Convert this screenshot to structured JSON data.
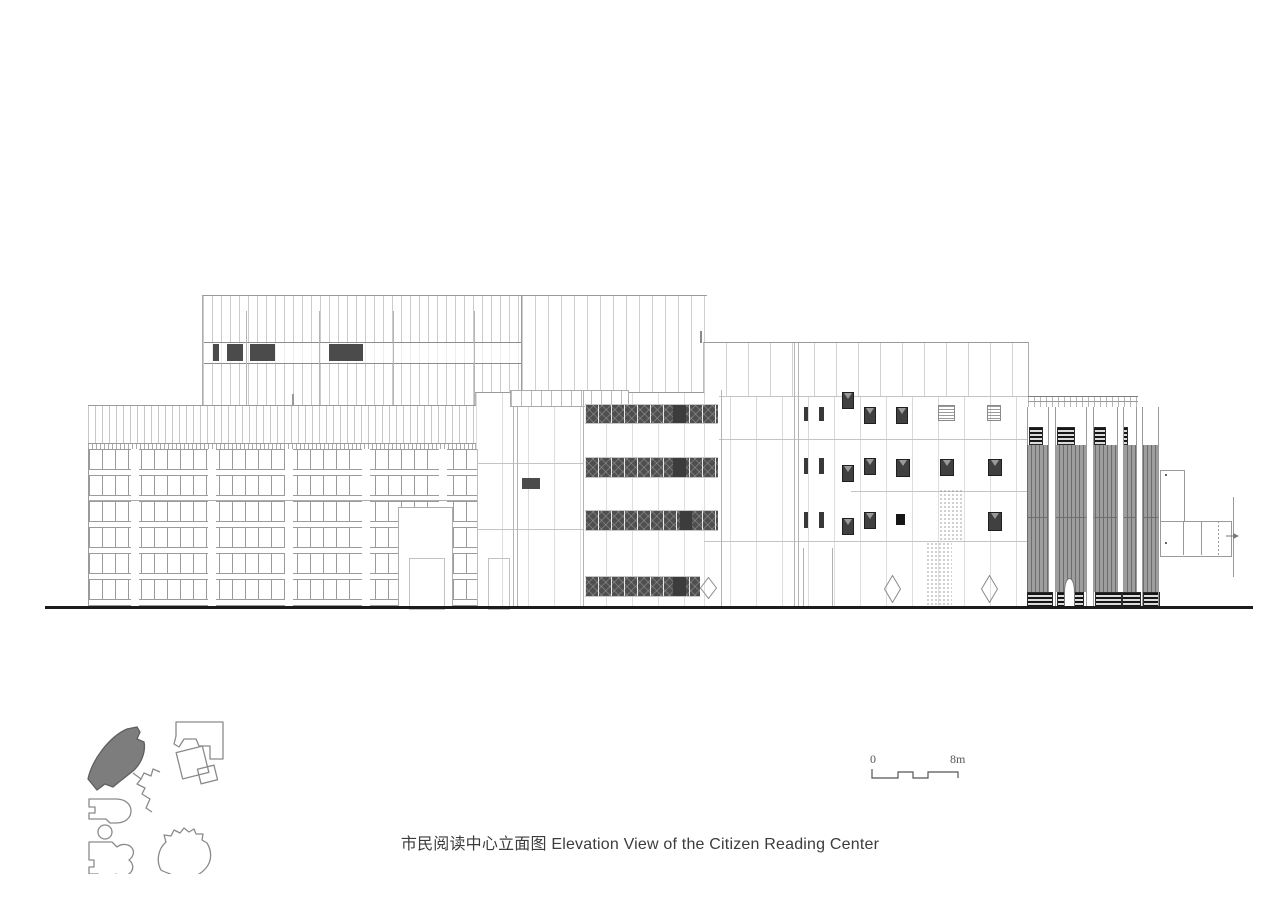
{
  "caption": {
    "text": "市民阅读中心立面图 Elevation View of the Citizen Reading Center"
  },
  "scale_bar": {
    "zero_label": "0",
    "end_label": "8m"
  },
  "colors": {
    "dark_window": "#4b4b4b",
    "louver": "#4f4f4f",
    "curtain": "#9e9e9e",
    "ground": "#1c1c1c",
    "site_fill": "#7d7d7d",
    "line": "#9a9a9a",
    "text": "#3c3c3c"
  }
}
